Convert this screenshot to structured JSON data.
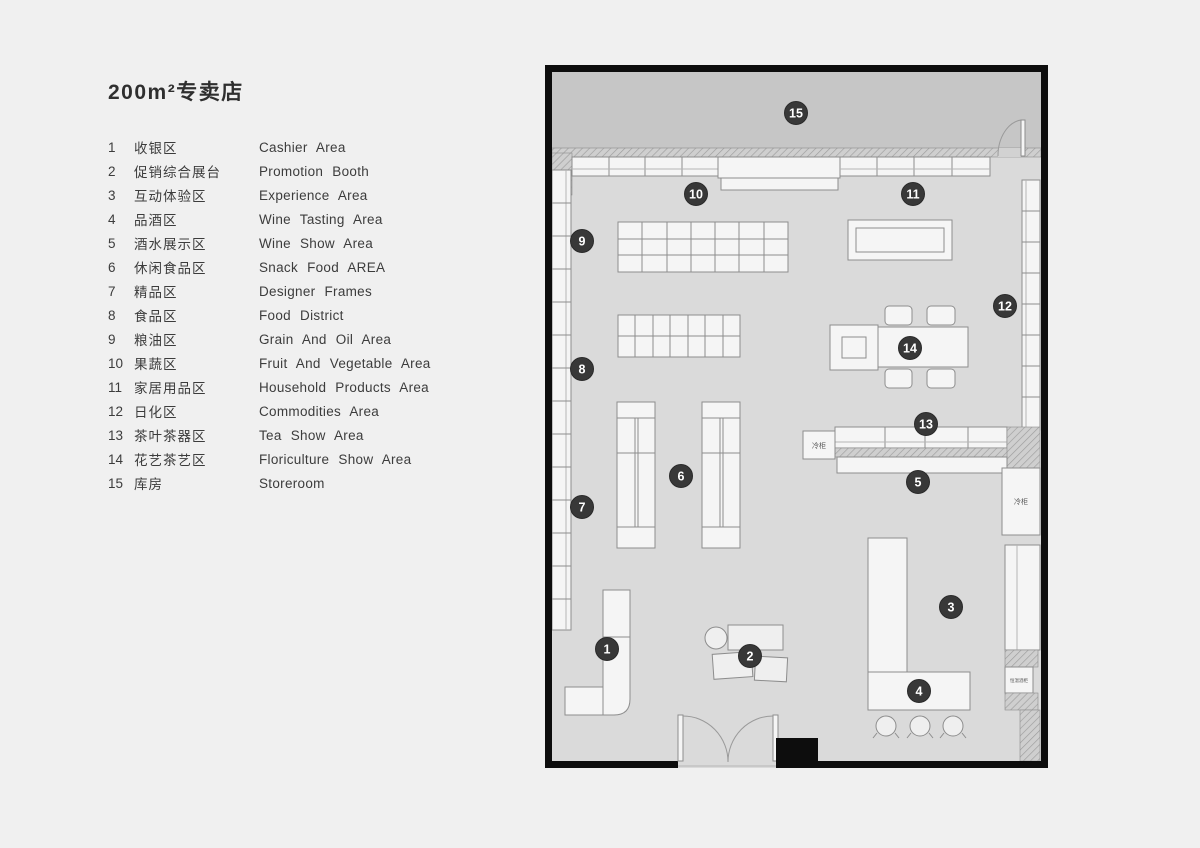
{
  "title": "200m²专卖店",
  "legend": {
    "items": [
      {
        "num": "1",
        "zh": "收银区",
        "en": "Cashier Area"
      },
      {
        "num": "2",
        "zh": "促销综合展台",
        "en": "Promotion Booth"
      },
      {
        "num": "3",
        "zh": "互动体验区",
        "en": "Experience Area"
      },
      {
        "num": "4",
        "zh": "品酒区",
        "en": "Wine Tasting Area"
      },
      {
        "num": "5",
        "zh": "酒水展示区",
        "en": "Wine Show Area"
      },
      {
        "num": "6",
        "zh": "休闲食品区",
        "en": "Snack Food AREA"
      },
      {
        "num": "7",
        "zh": "精品区",
        "en": "Designer Frames"
      },
      {
        "num": "8",
        "zh": "食品区",
        "en": "Food District"
      },
      {
        "num": "9",
        "zh": "粮油区",
        "en": "Grain And Oil Area"
      },
      {
        "num": "10",
        "zh": "果蔬区",
        "en": "Fruit And Vegetable Area"
      },
      {
        "num": "11",
        "zh": "家居用品区",
        "en": "Household Products Area"
      },
      {
        "num": "12",
        "zh": "日化区",
        "en": "Commodities Area"
      },
      {
        "num": "13",
        "zh": "茶叶茶器区",
        "en": "Tea Show Area"
      },
      {
        "num": "14",
        "zh": "花艺茶艺区",
        "en": "Floriculture Show Area"
      },
      {
        "num": "15",
        "zh": "库房",
        "en": "Storeroom"
      }
    ]
  },
  "plan": {
    "markers": [
      "1",
      "2",
      "3",
      "4",
      "5",
      "6",
      "7",
      "8",
      "9",
      "10",
      "11",
      "12",
      "13",
      "14",
      "15"
    ],
    "labels": {
      "cold_cabinet_left": "冷柜",
      "cold_cabinet_right": "冷柜",
      "wine_cabinet": "恒温酒柜"
    }
  },
  "colors": {
    "page_bg": "#f0f0f0",
    "wall": "#0d0d0d",
    "floor": "#dadada",
    "storeroom": "#c6c6c6",
    "fixture_fill": "#f5f5f5",
    "fixture_stroke": "#8d8d8d",
    "marker_fill": "#383838",
    "marker_text": "#ffffff"
  }
}
